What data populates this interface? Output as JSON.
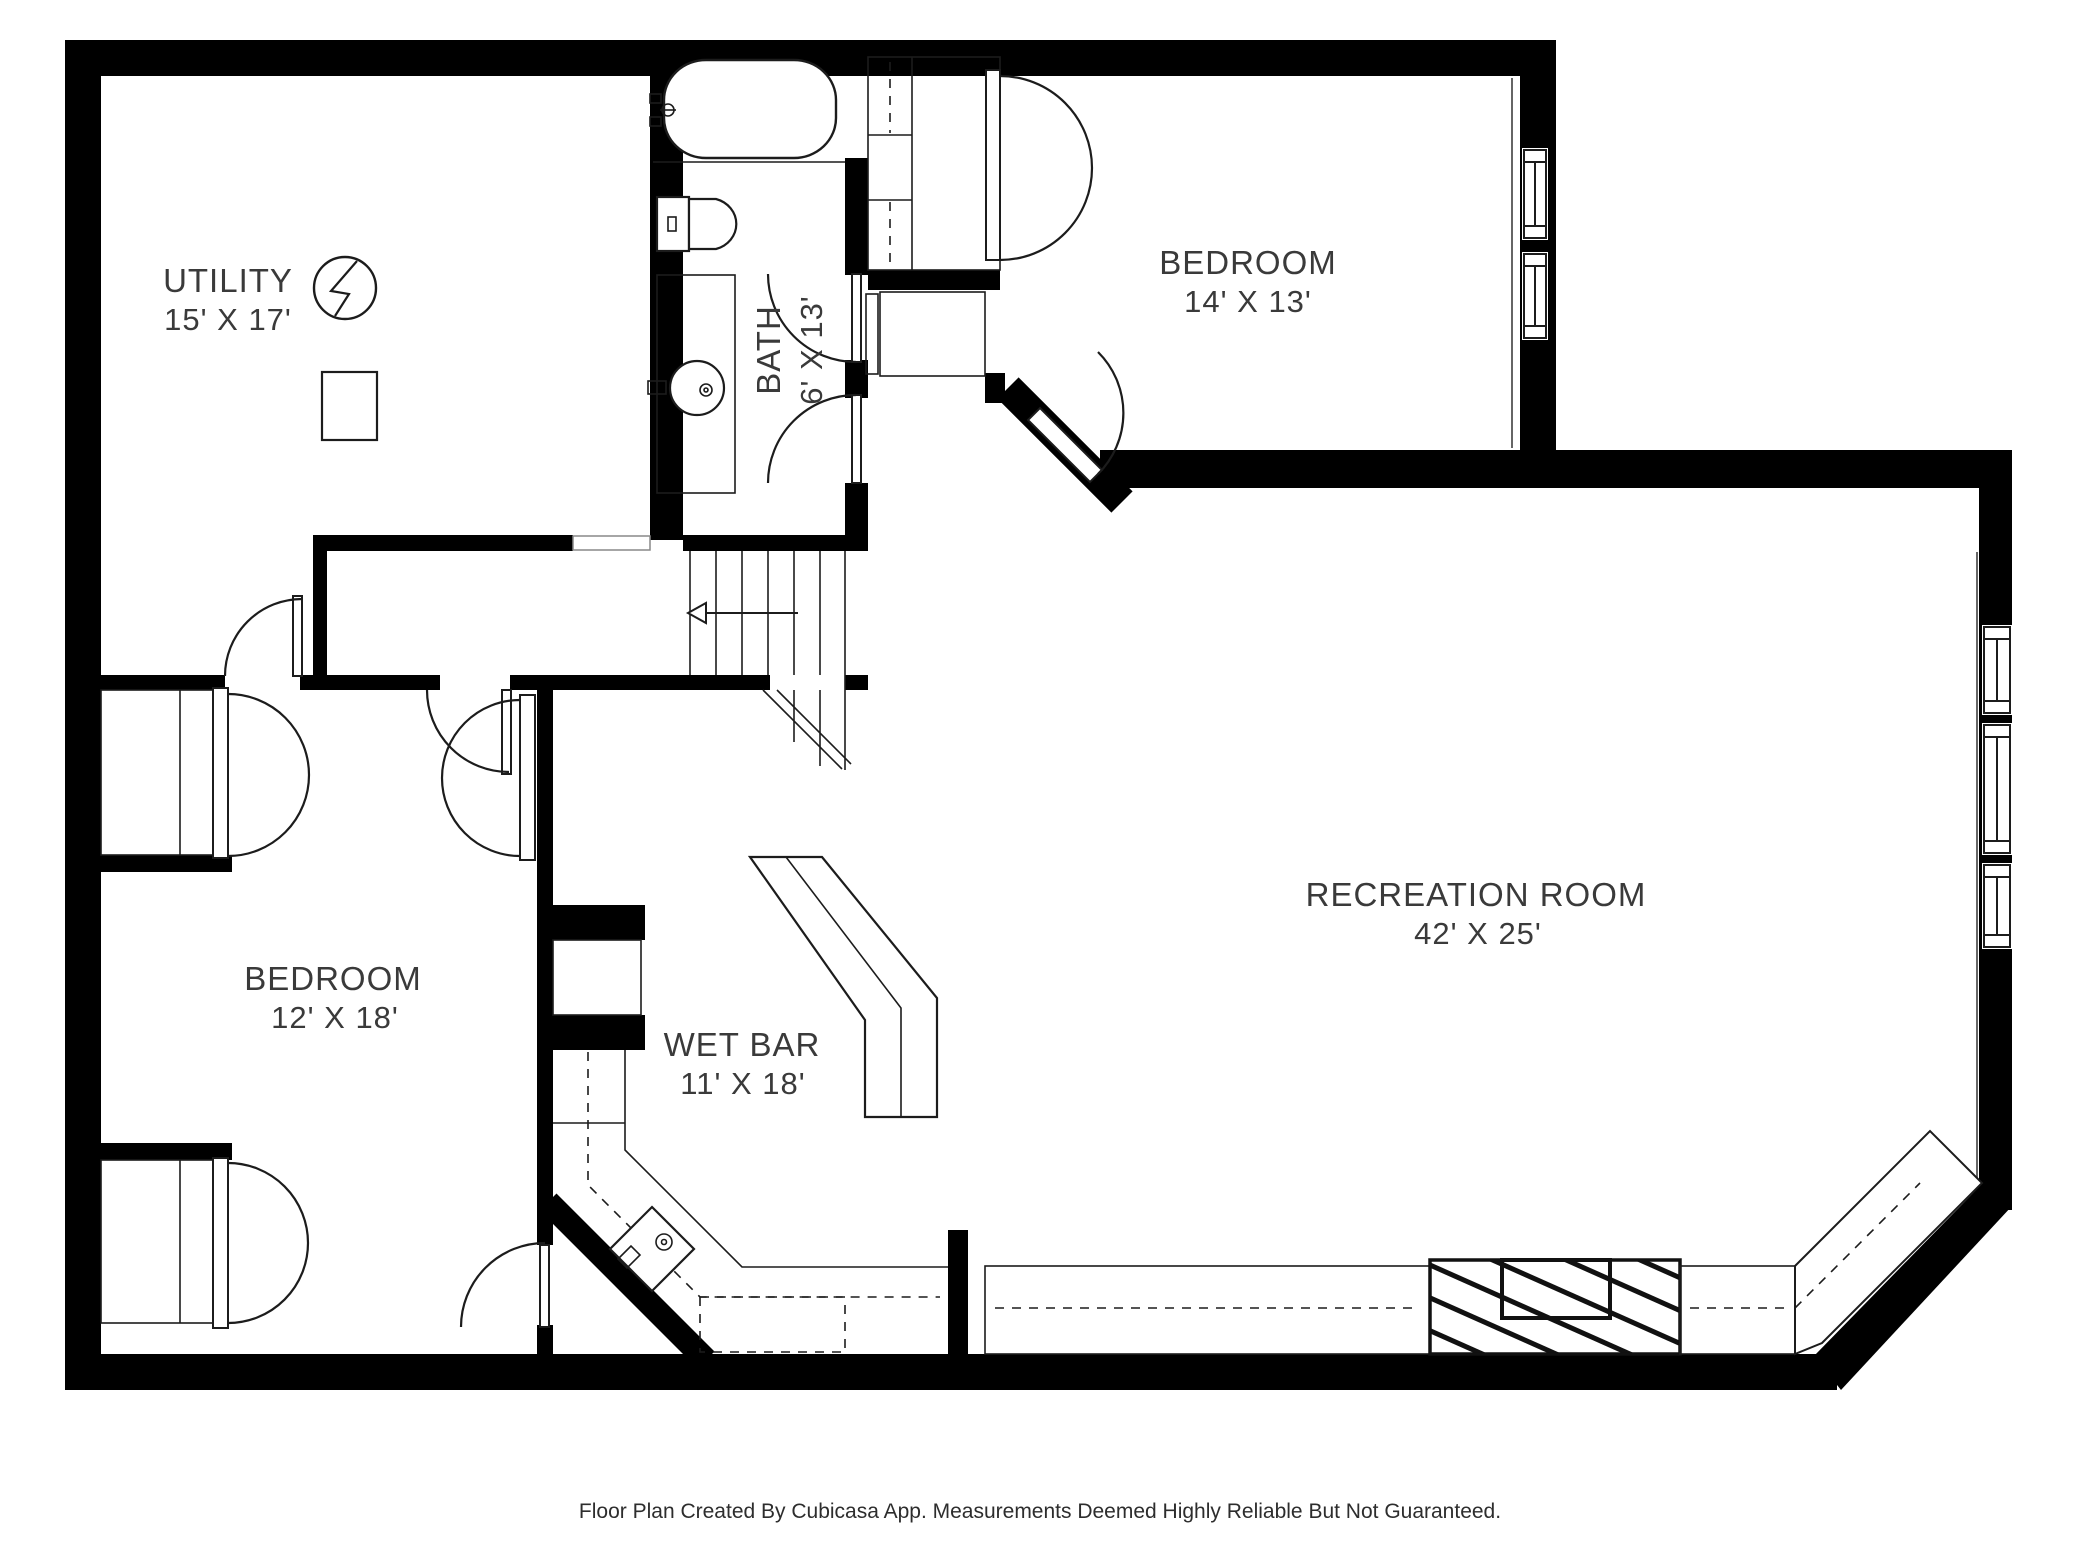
{
  "rooms": [
    {
      "id": "utility",
      "name": "UTILITY",
      "dims": "15' X 17'"
    },
    {
      "id": "bath",
      "name": "BATH",
      "dims": "6' X 13'"
    },
    {
      "id": "bedroom_top_right",
      "name": "BEDROOM",
      "dims": "14' X 13'"
    },
    {
      "id": "bedroom_left",
      "name": "BEDROOM",
      "dims": "12' X 18'"
    },
    {
      "id": "wet_bar",
      "name": "WET BAR",
      "dims": "11' X 18'"
    },
    {
      "id": "recreation",
      "name": "RECREATION ROOM",
      "dims": "42' X 25'"
    }
  ],
  "footer": {
    "text": "Floor Plan Created By Cubicasa App. Measurements Deemed Highly Reliable But Not Guaranteed."
  },
  "colors": {
    "wall": "#000000",
    "label": "#3a3a3a",
    "background": "#ffffff"
  }
}
